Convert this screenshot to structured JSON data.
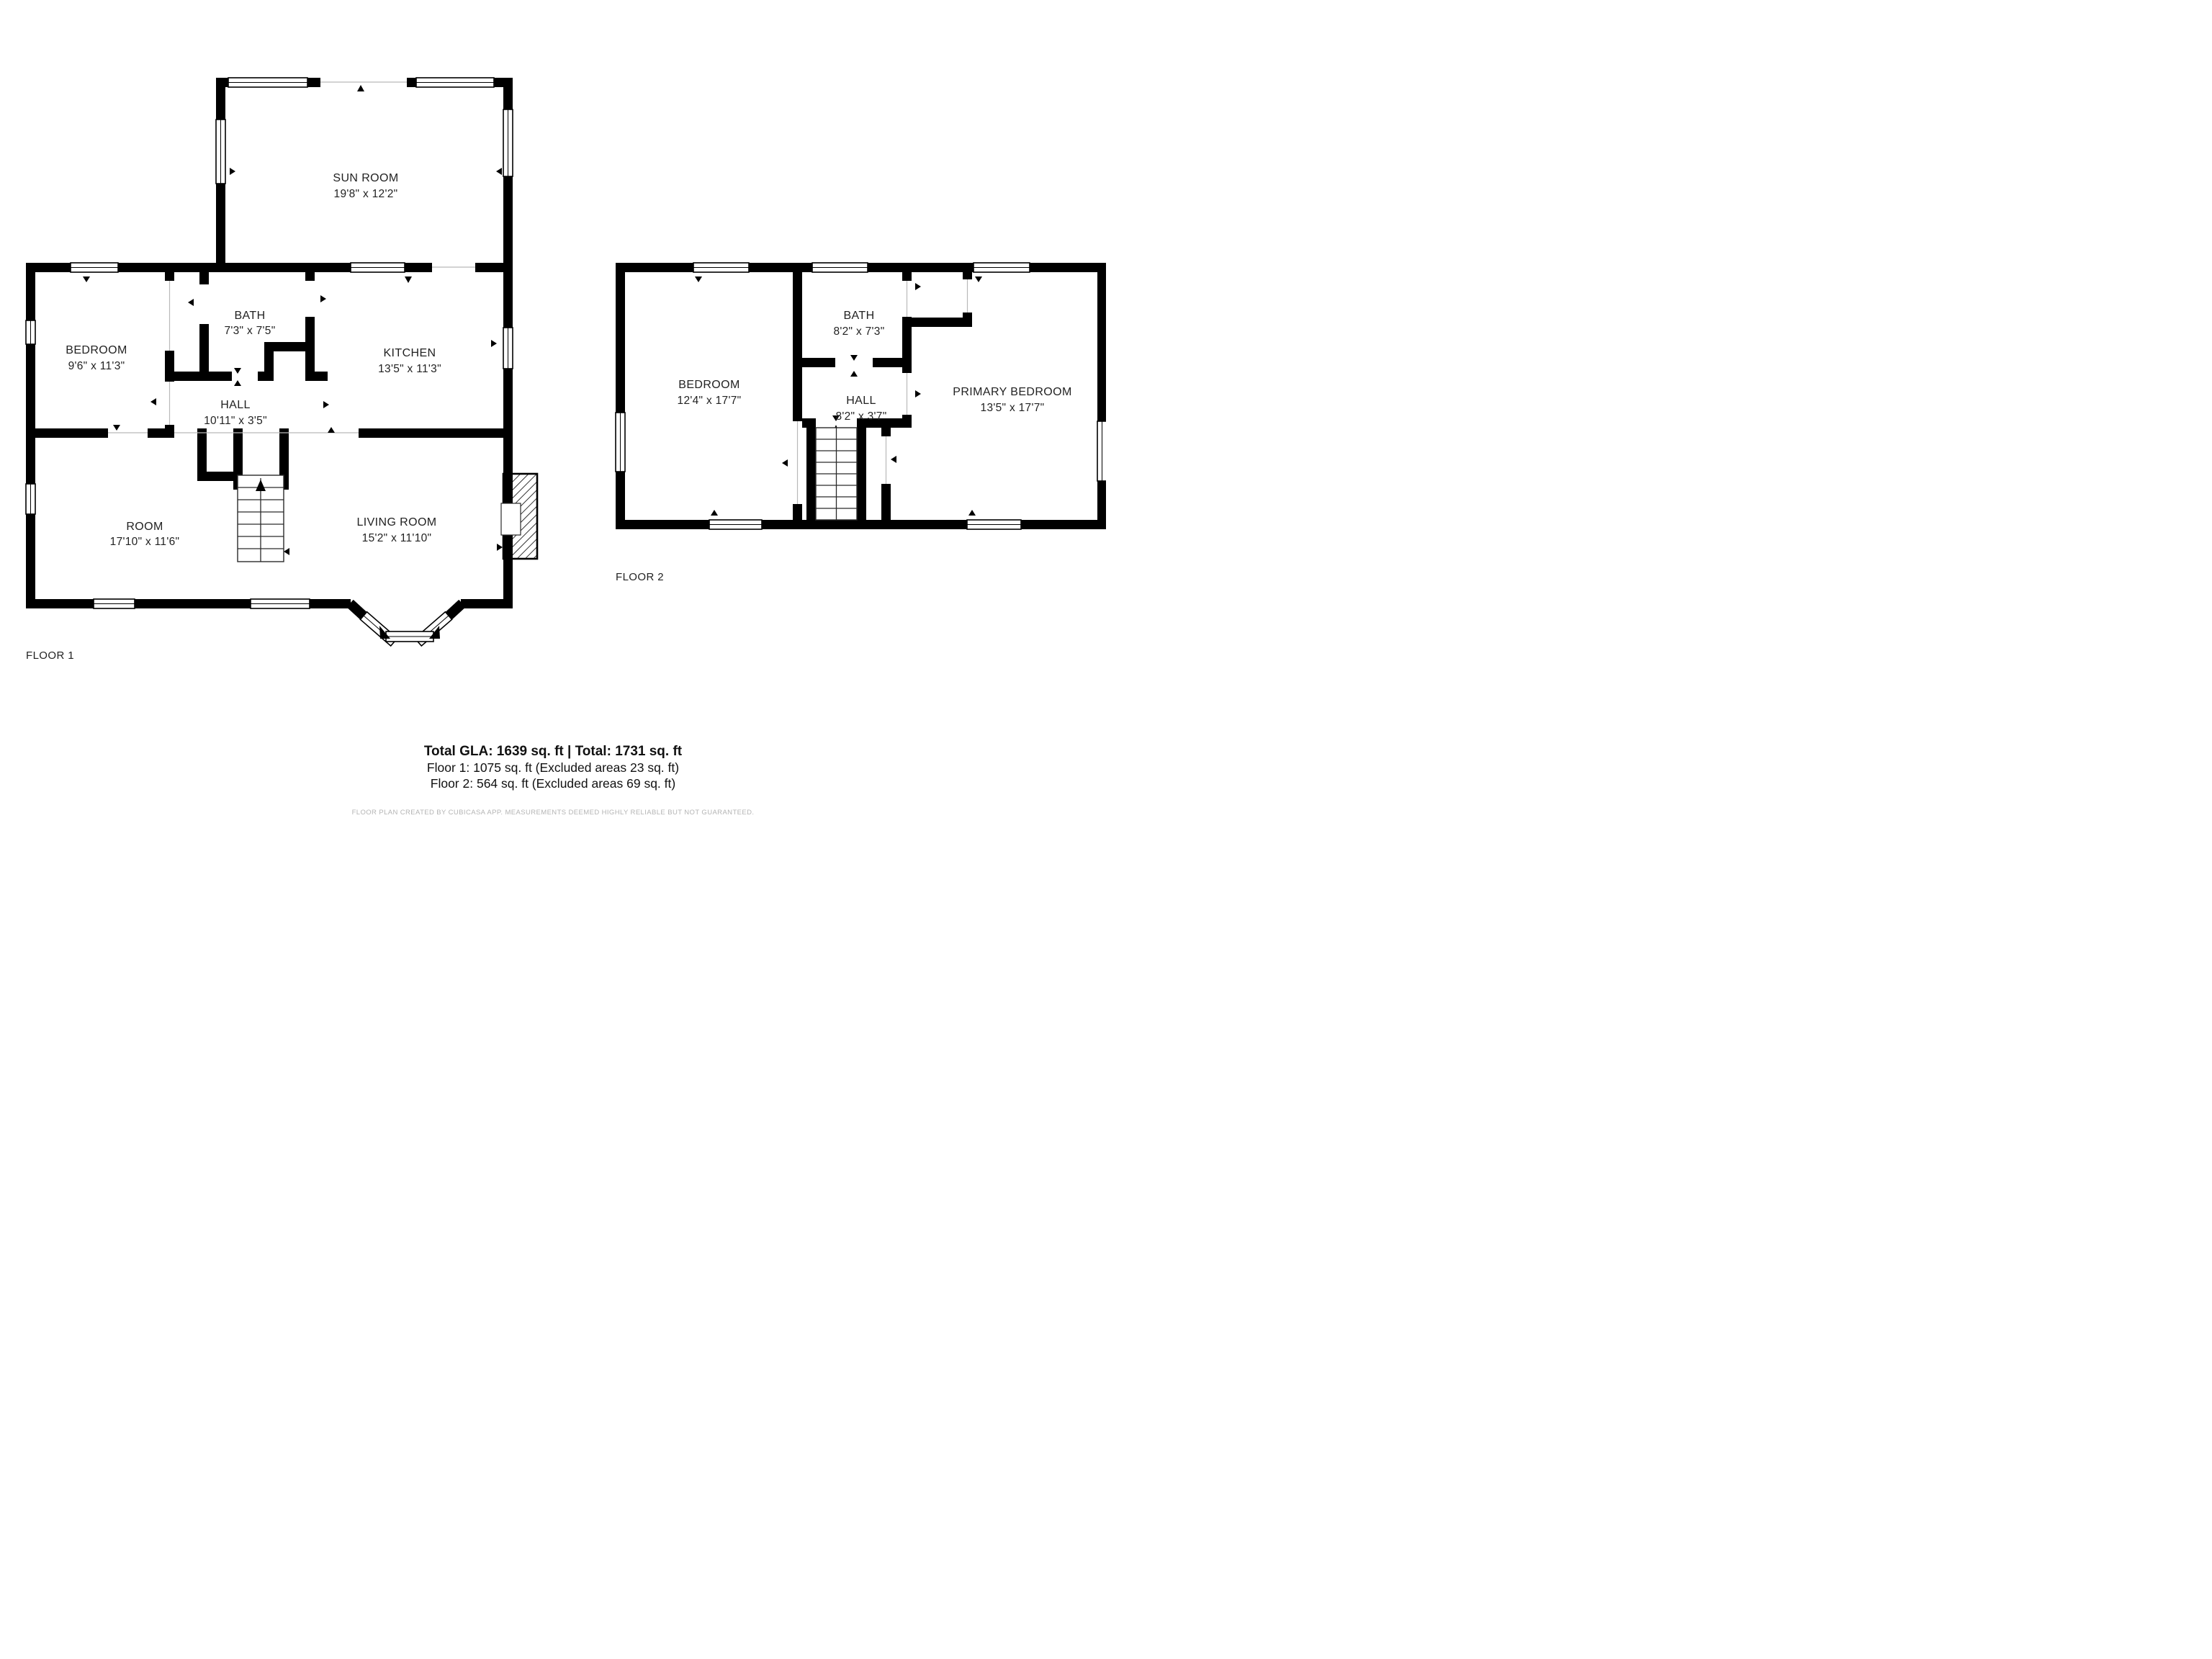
{
  "floor1": {
    "caption": "FLOOR 1",
    "rooms": {
      "sunroom": {
        "name": "SUN ROOM",
        "dims": "19'8\" x 12'2\""
      },
      "bedroom": {
        "name": "BEDROOM",
        "dims": "9'6\" x 11'3\""
      },
      "bath": {
        "name": "BATH",
        "dims": "7'3\" x 7'5\""
      },
      "kitchen": {
        "name": "KITCHEN",
        "dims": "13'5\" x 11'3\""
      },
      "hall": {
        "name": "HALL",
        "dims": "10'11\" x 3'5\""
      },
      "room": {
        "name": "ROOM",
        "dims": "17'10\" x 11'6\""
      },
      "living": {
        "name": "LIVING ROOM",
        "dims": "15'2\" x 11'10\""
      }
    }
  },
  "floor2": {
    "caption": "FLOOR 2",
    "rooms": {
      "bedroom": {
        "name": "BEDROOM",
        "dims": "12'4\" x 17'7\""
      },
      "bath": {
        "name": "BATH",
        "dims": "8'2\" x 7'3\""
      },
      "hall": {
        "name": "HALL",
        "dims": "8'2\" x 3'7\""
      },
      "primary": {
        "name": "PRIMARY BEDROOM",
        "dims": "13'5\" x 17'7\""
      }
    }
  },
  "footer": {
    "total_line": "Total GLA: 1639 sq. ft | Total: 1731 sq. ft",
    "floor1_line": "Floor 1: 1075 sq. ft (Excluded areas 23 sq. ft)",
    "floor2_line": "Floor 2: 564 sq. ft (Excluded areas 69 sq. ft)",
    "credit": "FLOOR PLAN CREATED BY CUBICASA APP. MEASUREMENTS DEEMED HIGHLY RELIABLE BUT NOT GUARANTEED."
  },
  "colors": {
    "wall": "#000000",
    "text": "#222222",
    "credit": "#b4b4b4"
  }
}
